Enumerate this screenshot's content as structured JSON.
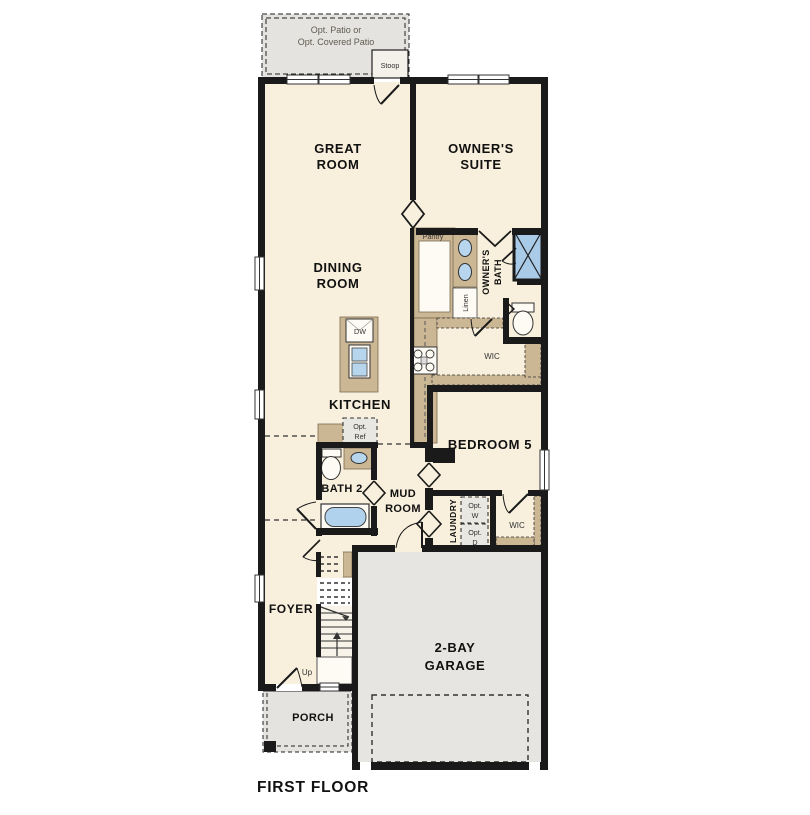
{
  "title": "FIRST FLOOR",
  "colors": {
    "floor": "#f8efdc",
    "wall": "#1a1a1a",
    "cabinet_tan": "#ccb795",
    "gray_area": "#e5e3df",
    "fixture_blue": "#b7d6ee",
    "shower_blue": "#a9cbe8"
  },
  "labels": {
    "patio_line1": "Opt. Patio or",
    "patio_line2": "Opt. Covered Patio",
    "stoop": "Stoop",
    "great_line1": "GREAT",
    "great_line2": "ROOM",
    "owner_line1": "OWNER'S",
    "owner_line2": "SUITE",
    "dining_line1": "DINING",
    "dining_line2": "ROOM",
    "pantry": "Pantry",
    "owner_bath_line1": "OWNER'S",
    "owner_bath_line2": "BATH",
    "linen": "Linen",
    "wic_upper": "WIC",
    "kitchen": "KITCHEN",
    "dw": "DW",
    "opt_ref_line1": "Opt.",
    "opt_ref_line2": "Ref",
    "bath2": "BATH 2",
    "mud_line1": "MUD",
    "mud_line2": "ROOM",
    "bedroom5": "BEDROOM 5",
    "laundry": "LAUNDRY",
    "opt_w_line1": "Opt.",
    "opt_w_line2": "W",
    "opt_d_line1": "Opt.",
    "opt_d_line2": "D",
    "wic_lower": "WIC",
    "foyer": "FOYER",
    "up": "Up",
    "garage_line1": "2-BAY",
    "garage_line2": "GARAGE",
    "porch": "PORCH"
  }
}
